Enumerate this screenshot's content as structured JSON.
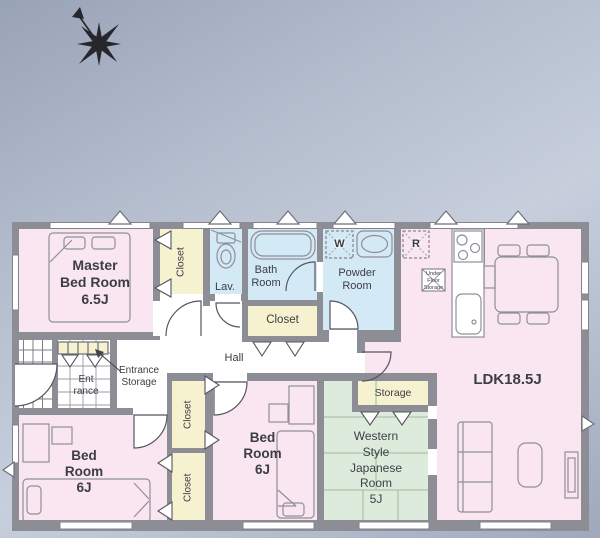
{
  "rooms": {
    "master_bedroom": {
      "lines": [
        "Master",
        "Bed Room",
        "6.5J"
      ]
    },
    "closet_top": {
      "label": "Closet"
    },
    "lavatory": {
      "label": "Lav."
    },
    "bathroom": {
      "lines": [
        "Bath",
        "Room"
      ]
    },
    "powder_room": {
      "lines": [
        "Powder",
        "Room"
      ]
    },
    "closet_middle": {
      "label": "Closet"
    },
    "washing_machine": {
      "label": "W"
    },
    "refrigerator": {
      "label": "R"
    },
    "under_floor_storage": {
      "lines": [
        "Under",
        "Floor",
        "Storage"
      ]
    },
    "ldk": {
      "label": "LDK18.5J"
    },
    "hall": {
      "label": "Hall"
    },
    "entrance": {
      "lines": [
        "Ent",
        "rance"
      ]
    },
    "entrance_storage": {
      "lines": [
        "Entrance",
        "Storage"
      ]
    },
    "bedroom_left": {
      "lines": [
        "Bed",
        "Room",
        "6J"
      ]
    },
    "bedroom_middle": {
      "lines": [
        "Bed",
        "Room",
        "6J"
      ]
    },
    "japanese_room": {
      "lines": [
        "Western",
        "Style",
        "Japanese",
        "Room",
        "5J"
      ]
    },
    "storage": {
      "label": "Storage"
    },
    "closet_column_upper": {
      "label": "Closet"
    },
    "closet_column_lower": {
      "label": "Closet"
    }
  },
  "colors": {
    "wall": "#8d8d96",
    "room_pink": "#f9e6f0",
    "room_blue": "#d3e9f5",
    "room_yellow": "#f6f2cf",
    "room_green": "#dcebdb",
    "background_dark": "#99a3b6",
    "background_light": "#c7cfdd"
  }
}
